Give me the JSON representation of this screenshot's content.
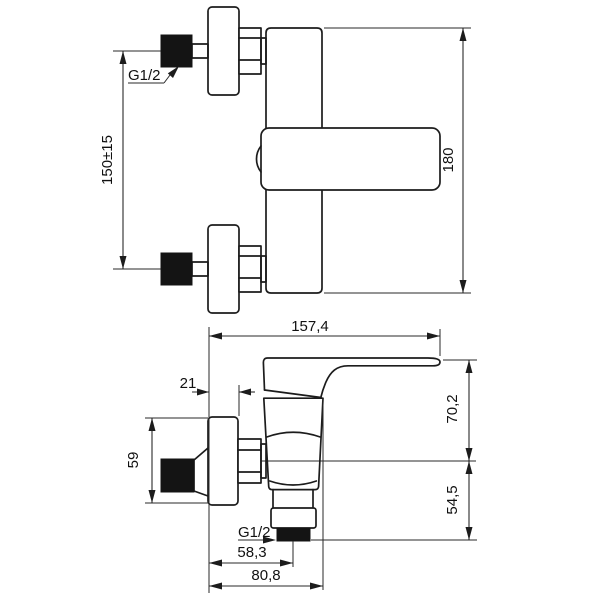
{
  "page": {
    "background": "#ffffff",
    "description": "Technical dimension drawing of a wall-mounted single-lever shower mixer, two orthographic views with millimetre dimensions",
    "line_color": "#1c1c1c"
  },
  "views": {
    "upper": {
      "name": "upper view - wall connections and overall height",
      "labels": {
        "thread": "G1/2",
        "spacing": "150±15",
        "height": "180"
      }
    },
    "lower": {
      "name": "lower view - profile with lever handle and bottom outlet",
      "labels": {
        "depth": "157,4",
        "plate_depth": "21",
        "plate_height": "59",
        "handle_height": "70,2",
        "outlet_drop": "54,5",
        "thread": "G1/2",
        "outlet_offset": "58,3",
        "base_depth": "80,8"
      }
    }
  }
}
